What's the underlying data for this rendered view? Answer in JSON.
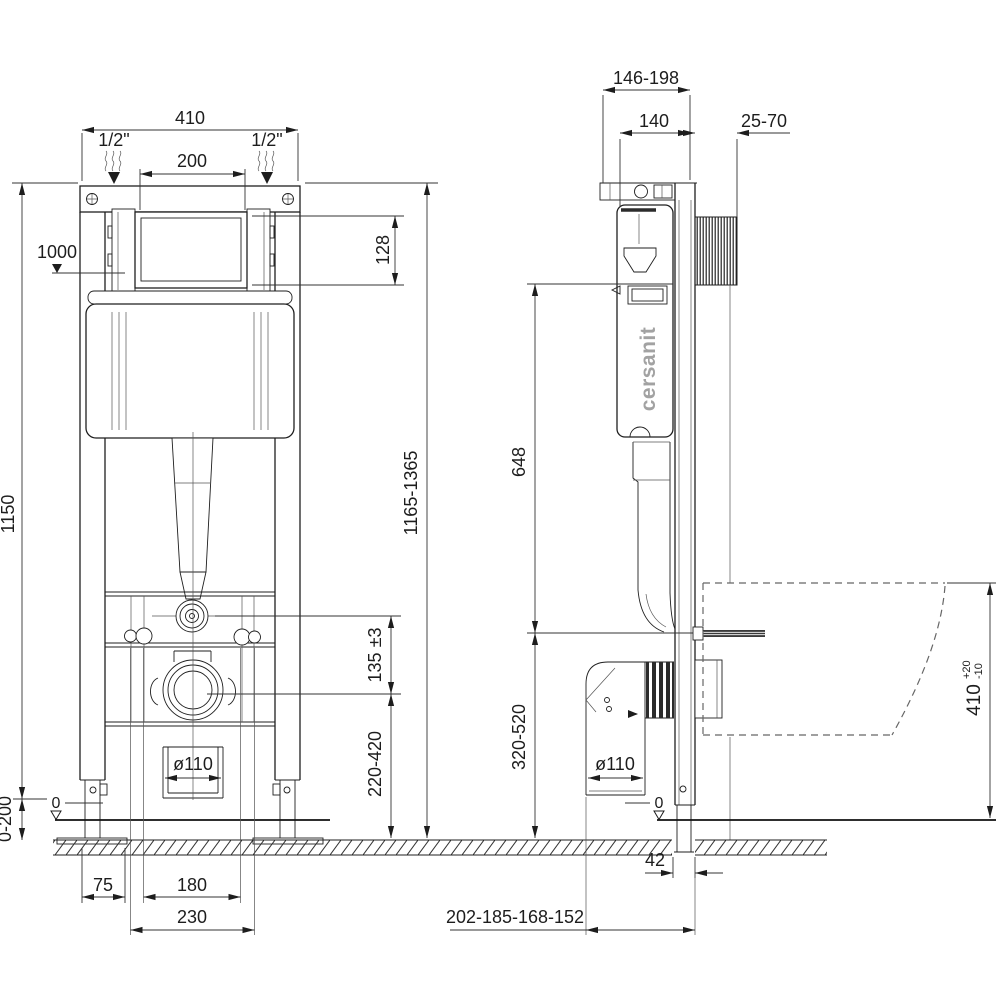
{
  "brand": {
    "logo": "cersanit"
  },
  "front_view": {
    "frame_width": "410",
    "water_inlet_left": "1/2\"",
    "water_inlet_right": "1/2\"",
    "flush_opening_width": "200",
    "flush_opening_height": "128",
    "water_supply_level": "1000",
    "frame_height": "1150",
    "installed_height_range": "1165-1365",
    "flush_to_outlet_spacing": "135 ±3",
    "outlet_height_range": "220-420",
    "drain_diameter": "ø110",
    "zero_level": "0",
    "floor_buildup_range": "0-200",
    "foot_offset": "75",
    "fixing_spacing_inner": "180",
    "fixing_spacing_outer": "230"
  },
  "side_view": {
    "depth_adjust_range": "146-198",
    "frame_depth": "140",
    "wall_distance_range": "25-70",
    "top_to_outlet": "648",
    "outlet_height_range": "320-520",
    "drain_diameter": "ø110",
    "zero_level": "0",
    "leg_wall_offset": "42",
    "drain_wall_offsets": "202-185-168-152",
    "bowl_top_height": "410",
    "bowl_tolerance_plus": "+20",
    "bowl_tolerance_minus": "-10"
  }
}
